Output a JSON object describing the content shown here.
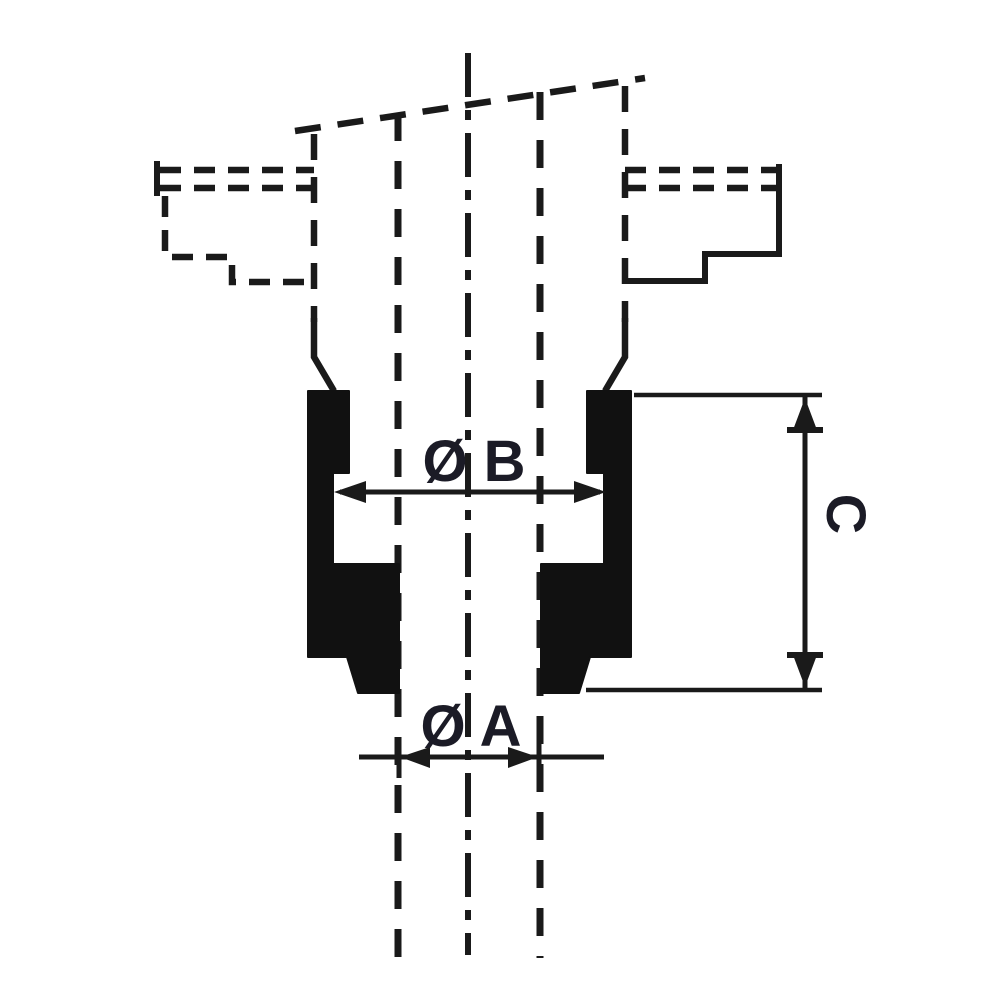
{
  "diagram": {
    "dimension_labels": {
      "b": "Ø B",
      "a": "Ø A",
      "c": "C"
    },
    "colors": {
      "line": "#1a1a1a",
      "section_fill": "#111111",
      "label_text": "#1b1b26",
      "background": "#ffffff"
    }
  }
}
